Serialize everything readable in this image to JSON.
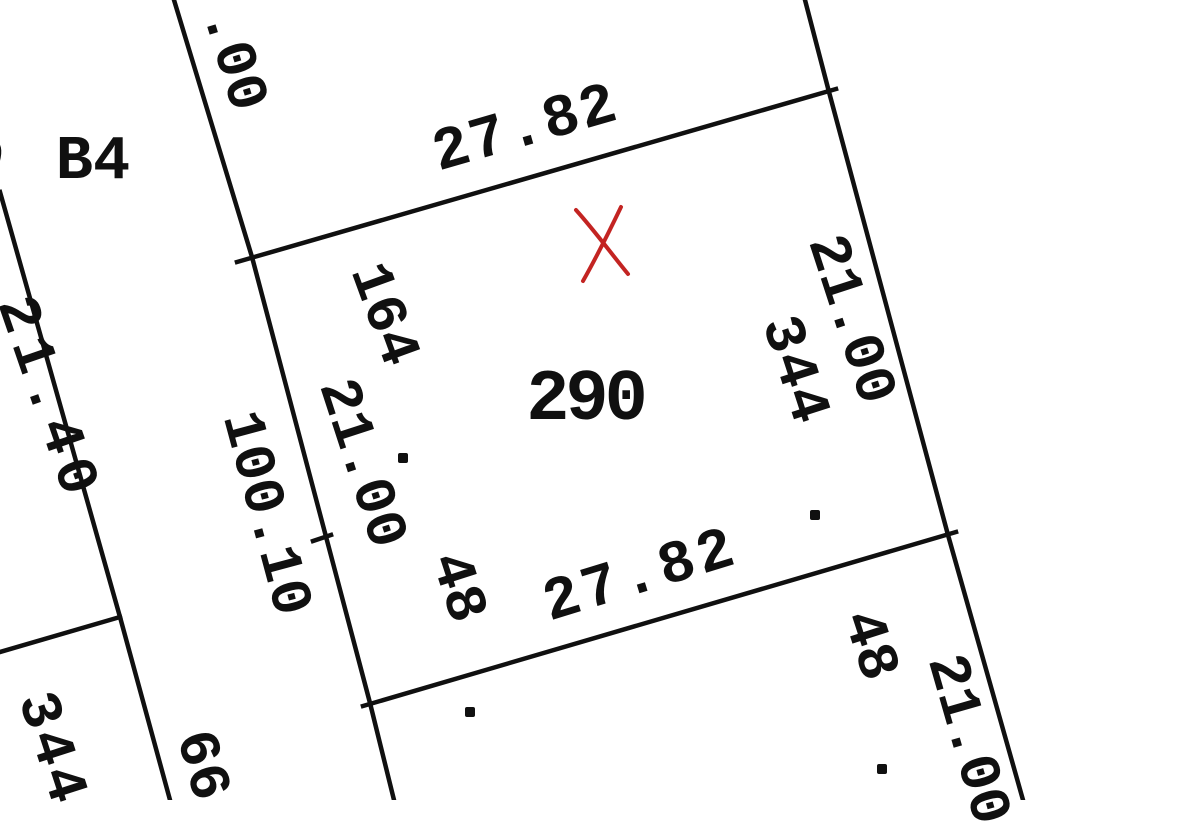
{
  "map": {
    "kind": "cadastral-plat-detail",
    "background": "#ffffff",
    "ink_color": "#101010",
    "red_marker_color": "#c32422",
    "parcel_number": "290",
    "labels": [
      {
        "name": "parcel-number-290",
        "text": "290",
        "x": 585,
        "y": 400,
        "rot": 0,
        "size": 72,
        "ls": -4
      },
      {
        "name": "block-label-b4",
        "text": "B4",
        "x": 93,
        "y": 162,
        "rot": 0,
        "size": 62,
        "ls": 0
      },
      {
        "name": "partial-digit-left-edge",
        "text": "0",
        "x": -12,
        "y": 160,
        "rot": 10,
        "size": 50,
        "ls": 0
      },
      {
        "name": "dim-00-top",
        "text": ".00",
        "x": 232,
        "y": 60,
        "rot": 73,
        "size": 58,
        "ls": 0
      },
      {
        "name": "dim-27-82-north",
        "text": "27.82",
        "x": 526,
        "y": 130,
        "rot": -16,
        "size": 60,
        "ls": 2
      },
      {
        "name": "dim-21-00-east",
        "text": "21.00",
        "x": 849,
        "y": 320,
        "rot": 72,
        "size": 58,
        "ls": 0
      },
      {
        "name": "lot-label-344-east",
        "text": "344",
        "x": 793,
        "y": 371,
        "rot": 72,
        "size": 58,
        "ls": 2
      },
      {
        "name": "lot-label-164",
        "text": "164",
        "x": 382,
        "y": 315,
        "rot": 70,
        "size": 58,
        "ls": 0
      },
      {
        "name": "dim-21-00-west",
        "text": "21.00",
        "x": 360,
        "y": 464,
        "rot": 72,
        "size": 58,
        "ls": 0
      },
      {
        "name": "dim-100-10-road",
        "text": "100.10",
        "x": 264,
        "y": 514,
        "rot": 75,
        "size": 58,
        "ls": 0
      },
      {
        "name": "dim-21-40-far-west",
        "text": "21.40",
        "x": 46,
        "y": 400,
        "rot": 71,
        "size": 58,
        "ls": 8
      },
      {
        "name": "lot-label-48-west",
        "text": "48",
        "x": 456,
        "y": 588,
        "rot": 72,
        "size": 58,
        "ls": 0
      },
      {
        "name": "dim-27-82-south",
        "text": "27.82",
        "x": 641,
        "y": 577,
        "rot": -17,
        "size": 60,
        "ls": 4
      },
      {
        "name": "lot-label-48-southeast",
        "text": "48",
        "x": 868,
        "y": 646,
        "rot": 72,
        "size": 58,
        "ls": 0
      },
      {
        "name": "dim-21-00-southeast",
        "text": "21.00",
        "x": 966,
        "y": 740,
        "rot": 74,
        "size": 58,
        "ls": 0
      },
      {
        "name": "lot-label-344-southwest",
        "text": "344",
        "x": 50,
        "y": 750,
        "rot": 72,
        "size": 58,
        "ls": 4
      },
      {
        "name": "lot-label-66",
        "text": "66",
        "x": 200,
        "y": 766,
        "rot": 74,
        "size": 58,
        "ls": 0
      }
    ],
    "boundary_lines": [
      {
        "name": "road-west-line",
        "points": [
          [
            0,
            192
          ],
          [
            120,
            617
          ],
          [
            170,
            800
          ]
        ]
      },
      {
        "name": "road-branch-line",
        "points": [
          [
            120,
            617
          ],
          [
            0,
            652
          ]
        ]
      },
      {
        "name": "block-west-line",
        "points": [
          [
            174,
            0
          ],
          [
            252,
            257
          ],
          [
            370,
            703
          ],
          [
            394,
            800
          ]
        ]
      },
      {
        "name": "parcel-north-line",
        "points": [
          [
            237,
            262
          ],
          [
            836,
            89
          ]
        ]
      },
      {
        "name": "parcel-east-line",
        "points": [
          [
            805,
            0
          ],
          [
            829,
            92
          ],
          [
            948,
            535
          ],
          [
            1023,
            800
          ]
        ]
      },
      {
        "name": "parcel-south-line",
        "points": [
          [
            363,
            706
          ],
          [
            956,
            532
          ]
        ]
      },
      {
        "name": "survey-tick",
        "points": [
          [
            313,
            541
          ],
          [
            331,
            535
          ]
        ]
      }
    ],
    "line_width": 4.5,
    "red_x_marker": {
      "name": "red-x-marker",
      "stroke_width": 4,
      "paths": [
        "M576,210 C594,230 610,252 628,274",
        "M621,207 C609,232 596,258 583,281"
      ]
    },
    "survey_dots": [
      {
        "x": 403,
        "y": 458
      },
      {
        "x": 815,
        "y": 515
      },
      {
        "x": 470,
        "y": 712
      },
      {
        "x": 882,
        "y": 769
      }
    ]
  }
}
